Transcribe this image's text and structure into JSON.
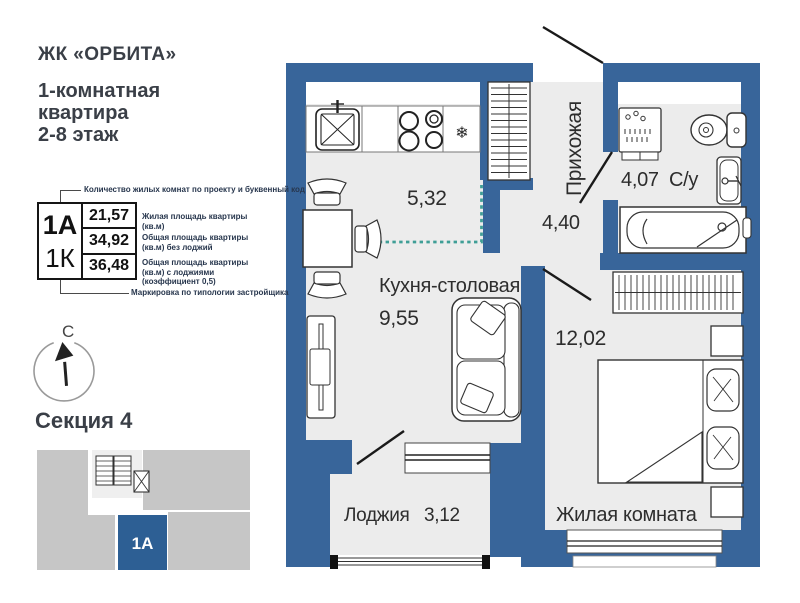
{
  "brand": {
    "title": "ЖК «ОРБИТА»"
  },
  "subtitle": {
    "line1": "1-комнатная",
    "line2": "квартира",
    "line3": "2-8 этаж"
  },
  "legend": {
    "top_label": "Количество жилых комнат по проекту и буквенный код",
    "bottom_label": "Маркировка по типологии застройщика",
    "code_primary": "1А",
    "code_secondary": "1К",
    "rows": [
      {
        "value": "21,57",
        "label": "Жилая площадь квартиры (кв.м)"
      },
      {
        "value": "34,92",
        "label": "Общая площадь квартиры (кв.м) без лоджий"
      },
      {
        "value": "36,48",
        "label": "Общая площадь квартиры (кв.м) с лоджиями (коэффициент 0,5)"
      }
    ]
  },
  "compass": {
    "north_label": "С"
  },
  "section": {
    "title": "Секция 4",
    "unit_label": "1А"
  },
  "plan": {
    "rooms": {
      "kitchen_zone": {
        "area": "5,32"
      },
      "kitchen_dining": {
        "name": "Кухня-столовая",
        "area": "9,55"
      },
      "hallway": {
        "name": "Прихожая",
        "area": "4,40"
      },
      "bathroom": {
        "name": "С/у",
        "area": "4,07"
      },
      "living_room": {
        "name": "Жилая комната",
        "area": "12,02"
      },
      "loggia": {
        "name": "Лоджия",
        "area": "3,12"
      }
    },
    "icons": {
      "snowflake_char": "❄"
    }
  },
  "colors": {
    "wall": "#38659A",
    "floor": "#ECECEC",
    "unit_block": "#2D5F94",
    "zone_line": "#3F9E96",
    "section_gray": "#C6C6C6"
  }
}
